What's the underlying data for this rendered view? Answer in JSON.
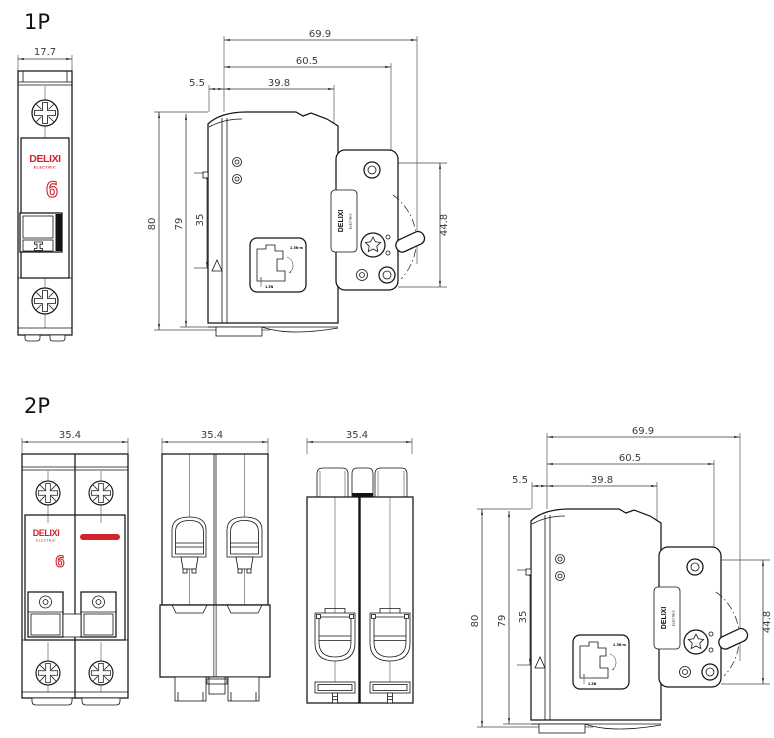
{
  "colors": {
    "brand_red": "#d2232a",
    "line": "#141414"
  },
  "sections": {
    "p1": {
      "label": "1P",
      "front": {
        "width": "17.7",
        "brand": "DELIXI",
        "brand_sub": "ELECTRIC",
        "rating": "6"
      },
      "side": {
        "depth_overall": "69.9",
        "depth_body": "60.5",
        "depth_case": "39.8",
        "rail_offset": "5.5",
        "height_overall": "80",
        "height_body": "79",
        "rail_window": "35",
        "front_height": "44.8",
        "label": "DELIXI",
        "label_sub": "ELECTRIC",
        "note_top": "2.5N·m",
        "note_bottom": "1.5N"
      }
    },
    "p2": {
      "label": "2P",
      "front": {
        "width": "35.4",
        "brand": "DELIXI",
        "brand_sub": "ELECTRIC",
        "rating": "6"
      },
      "top_view": {
        "width": "35.4"
      },
      "back_view": {
        "width": "35.4"
      },
      "side": {
        "depth_overall": "69.9",
        "depth_body": "60.5",
        "depth_case": "39.8",
        "rail_offset": "5.5",
        "height_overall": "80",
        "height_body": "79",
        "rail_window": "35",
        "front_height": "44.8",
        "label": "DELIXI",
        "label_sub": "ELECTRIC",
        "note_top": "2.5N·m",
        "note_bottom": "1.5N"
      }
    }
  }
}
